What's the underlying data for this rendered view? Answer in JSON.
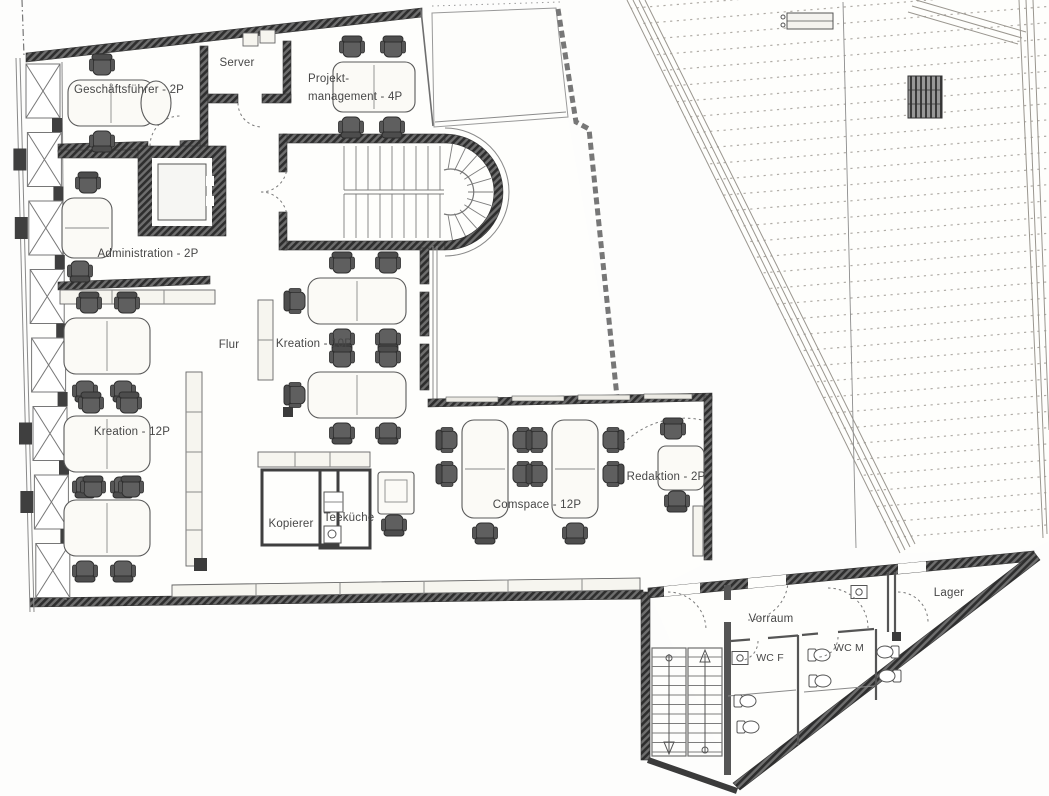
{
  "rooms": {
    "geschaeftsfuehrer": {
      "label": "Geschäftsführer - 2P"
    },
    "server": {
      "label": "Server"
    },
    "projektmanagement": {
      "line1": "Projekt-",
      "line2": "management - 4P"
    },
    "administration": {
      "label": "Administration - 2P"
    },
    "flur": {
      "label": "Flur"
    },
    "kreation10": {
      "label": "Kreation - 10P"
    },
    "kreation12": {
      "label": "Kreation - 12P"
    },
    "kopierer": {
      "label": "Kopierer"
    },
    "teekueche": {
      "label": "Teeküche"
    },
    "comspace": {
      "label": "Comspace - 12P"
    },
    "redaktion": {
      "label": "Redaktion - 2P"
    },
    "vorraum": {
      "label": "Vorraum"
    },
    "wc_f": {
      "label": "WC F"
    },
    "wc_m": {
      "label": "WC M"
    },
    "lager": {
      "label": "Lager"
    }
  },
  "colors": {
    "wall_dark": "#3f3f3f",
    "line_gray": "#6f6f6f",
    "paper": "#fdfdfc",
    "desk_fill": "#fbfaf6",
    "chair_fill": "#5f5f5f",
    "label_text": "#474747",
    "roof_hatch": "#b0aca6"
  },
  "facade": {
    "panel_count": 8
  },
  "roof": {
    "hatch_line_count": 35
  },
  "furniture": {
    "desks": [
      {
        "x": 68,
        "y": 80,
        "w": 86,
        "h": 46,
        "rx": 12,
        "div": "v"
      },
      {
        "x": 333,
        "y": 62,
        "w": 82,
        "h": 50,
        "rx": 10,
        "div": "v"
      },
      {
        "x": 62,
        "y": 198,
        "w": 50,
        "h": 60,
        "rx": 12,
        "div": "h"
      },
      {
        "x": 64,
        "y": 318,
        "w": 86,
        "h": 56,
        "rx": 12,
        "div": "v"
      },
      {
        "x": 64,
        "y": 416,
        "w": 86,
        "h": 56,
        "rx": 12,
        "div": "v"
      },
      {
        "x": 64,
        "y": 500,
        "w": 86,
        "h": 56,
        "rx": 12,
        "div": "v"
      },
      {
        "x": 308,
        "y": 278,
        "w": 98,
        "h": 46,
        "rx": 12,
        "div": "v"
      },
      {
        "x": 308,
        "y": 372,
        "w": 98,
        "h": 46,
        "rx": 12,
        "div": "v"
      },
      {
        "x": 462,
        "y": 420,
        "w": 46,
        "h": 98,
        "rx": 12,
        "div": "h"
      },
      {
        "x": 552,
        "y": 420,
        "w": 46,
        "h": 98,
        "rx": 12,
        "div": "h"
      },
      {
        "x": 658,
        "y": 446,
        "w": 46,
        "h": 44,
        "rx": 8
      },
      {
        "x": 378,
        "y": 472,
        "w": 36,
        "h": 42,
        "rx": 3,
        "inner": true
      }
    ],
    "chairs": [
      {
        "x": 102,
        "y": 66,
        "r": 0
      },
      {
        "x": 102,
        "y": 140,
        "r": 180
      },
      {
        "x": 352,
        "y": 48,
        "r": 0
      },
      {
        "x": 393,
        "y": 48,
        "r": 0
      },
      {
        "x": 351,
        "y": 126,
        "r": 180
      },
      {
        "x": 392,
        "y": 126,
        "r": 180
      },
      {
        "x": 88,
        "y": 184,
        "r": 0
      },
      {
        "x": 80,
        "y": 270,
        "r": 180
      },
      {
        "x": 89,
        "y": 304,
        "r": 0
      },
      {
        "x": 127,
        "y": 304,
        "r": 0
      },
      {
        "x": 85,
        "y": 390,
        "r": 180
      },
      {
        "x": 123,
        "y": 390,
        "r": 180
      },
      {
        "x": 91,
        "y": 404,
        "r": 0
      },
      {
        "x": 129,
        "y": 404,
        "r": 0
      },
      {
        "x": 85,
        "y": 486,
        "r": 180
      },
      {
        "x": 123,
        "y": 486,
        "r": 180
      },
      {
        "x": 93,
        "y": 488,
        "r": 0
      },
      {
        "x": 131,
        "y": 488,
        "r": 0
      },
      {
        "x": 85,
        "y": 570,
        "r": 180
      },
      {
        "x": 123,
        "y": 570,
        "r": 180
      },
      {
        "x": 342,
        "y": 264,
        "r": 0
      },
      {
        "x": 388,
        "y": 264,
        "r": 0
      },
      {
        "x": 342,
        "y": 338,
        "r": 180
      },
      {
        "x": 388,
        "y": 338,
        "r": 180
      },
      {
        "x": 296,
        "y": 301,
        "r": 270
      },
      {
        "x": 342,
        "y": 358,
        "r": 0
      },
      {
        "x": 388,
        "y": 358,
        "r": 0
      },
      {
        "x": 342,
        "y": 432,
        "r": 180
      },
      {
        "x": 388,
        "y": 432,
        "r": 180
      },
      {
        "x": 296,
        "y": 395,
        "r": 270
      },
      {
        "x": 448,
        "y": 440,
        "r": 270
      },
      {
        "x": 448,
        "y": 474,
        "r": 270
      },
      {
        "x": 522,
        "y": 440,
        "r": 90
      },
      {
        "x": 522,
        "y": 474,
        "r": 90
      },
      {
        "x": 485,
        "y": 532,
        "r": 180
      },
      {
        "x": 538,
        "y": 440,
        "r": 270
      },
      {
        "x": 538,
        "y": 474,
        "r": 270
      },
      {
        "x": 612,
        "y": 440,
        "r": 90
      },
      {
        "x": 612,
        "y": 474,
        "r": 90
      },
      {
        "x": 575,
        "y": 532,
        "r": 180
      },
      {
        "x": 673,
        "y": 430,
        "r": 0
      },
      {
        "x": 677,
        "y": 500,
        "r": 180
      },
      {
        "x": 394,
        "y": 524,
        "r": 180
      }
    ]
  }
}
